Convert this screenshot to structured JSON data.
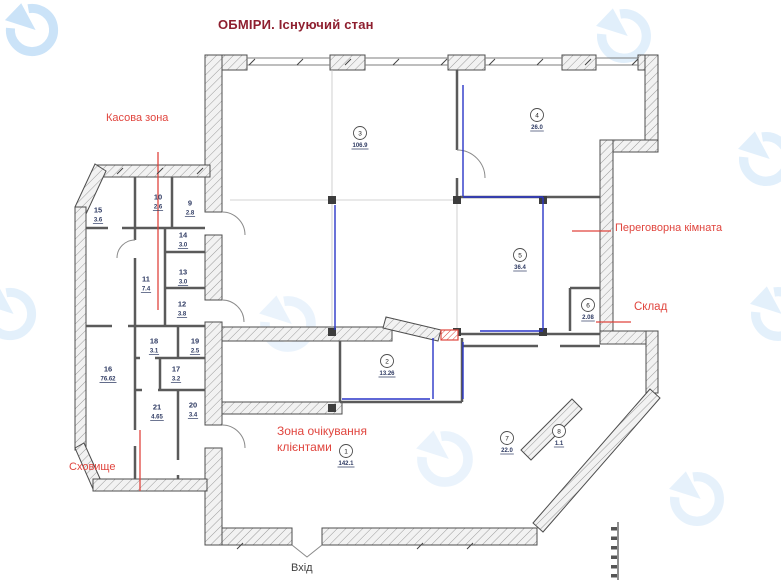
{
  "title": "ОБМІРИ. Існуючий стан",
  "labels": {
    "kasova_zona": "Касова зона",
    "perehovorna": "Переговорна кімната",
    "sklad": "Склад",
    "zona_line1": "Зона очікування",
    "zona_line2": "клієнтами",
    "skhovyshche": "Сховище",
    "vkhid": "Вхід"
  },
  "colors": {
    "title": "#8e1f2f",
    "annotation_red": "#e0453e",
    "plan_line": "#4d4d4d",
    "thin_wall": "#5a5a5a",
    "measure_blue": "#2a35c8",
    "watermark_blue": "#c9e2f8",
    "room_text": "#2f3b63"
  },
  "plan": {
    "rooms": [
      {
        "num": "1",
        "area": "142.1",
        "x": 346,
        "y": 451,
        "circled": true
      },
      {
        "num": "2",
        "area": "13.26",
        "x": 387,
        "y": 361,
        "circled": true
      },
      {
        "num": "3",
        "area": "106.9",
        "x": 360,
        "y": 133,
        "circled": true
      },
      {
        "num": "4",
        "area": "26.0",
        "x": 537,
        "y": 115,
        "circled": true
      },
      {
        "num": "5",
        "area": "36.4",
        "x": 520,
        "y": 255,
        "circled": true
      },
      {
        "num": "6",
        "area": "2.08",
        "x": 588,
        "y": 305,
        "circled": true
      },
      {
        "num": "7",
        "area": "22.0",
        "x": 507,
        "y": 438,
        "circled": true
      },
      {
        "num": "8",
        "area": "1.1",
        "x": 559,
        "y": 431,
        "circled": true
      },
      {
        "num": "9",
        "area": "2.8",
        "x": 190,
        "y": 203,
        "circled": false
      },
      {
        "num": "10",
        "area": "2.6",
        "x": 158,
        "y": 197,
        "circled": false
      },
      {
        "num": "11",
        "area": "7.4",
        "x": 146,
        "y": 279,
        "circled": false
      },
      {
        "num": "12",
        "area": "3.8",
        "x": 182,
        "y": 304,
        "circled": false
      },
      {
        "num": "13",
        "area": "3.0",
        "x": 183,
        "y": 272,
        "circled": false
      },
      {
        "num": "14",
        "area": "3.0",
        "x": 183,
        "y": 235,
        "circled": false
      },
      {
        "num": "15",
        "area": "3.6",
        "x": 98,
        "y": 210,
        "circled": false
      },
      {
        "num": "16",
        "area": "76.62",
        "x": 108,
        "y": 369,
        "circled": false
      },
      {
        "num": "17",
        "area": "3.2",
        "x": 176,
        "y": 369,
        "circled": false
      },
      {
        "num": "18",
        "area": "3.1",
        "x": 154,
        "y": 341,
        "circled": false
      },
      {
        "num": "19",
        "area": "2.5",
        "x": 195,
        "y": 341,
        "circled": false
      },
      {
        "num": "20",
        "area": "3.4",
        "x": 193,
        "y": 405,
        "circled": false
      },
      {
        "num": "21",
        "area": "4.65",
        "x": 157,
        "y": 407,
        "circled": false
      }
    ]
  }
}
